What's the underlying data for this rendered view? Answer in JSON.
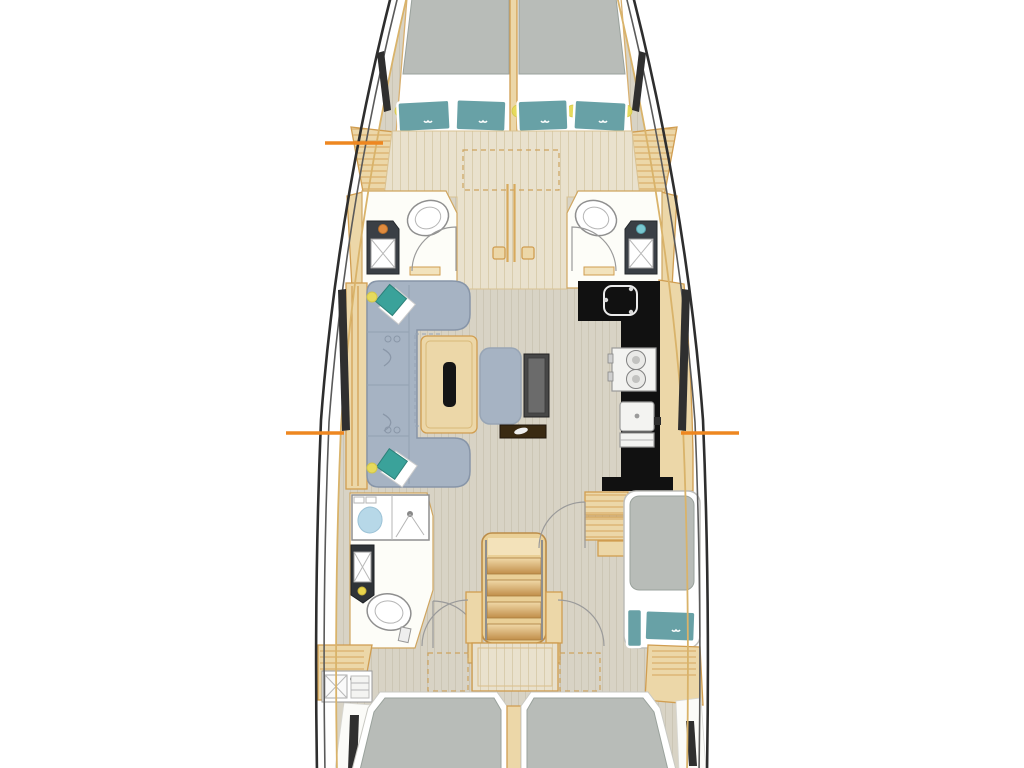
{
  "title": "Sailing yacht interior layout plan (top view)",
  "colors": {
    "page_bg": "#ffffff",
    "hull_outline": "#2e2e2e",
    "deck_trim": "#d9b36a",
    "floor_forward": "#e9e1cd",
    "floor_salon": "#d8d3c5",
    "wood": "#ecd7a8",
    "wood_border": "#d09d50",
    "mattress_gray": "#b8bcb8",
    "pillow_teal": "#68a1a6",
    "sofa_blue": "#a6b3c3",
    "cushion_teal": "#3aa29a",
    "counter_black": "#111111",
    "chart_table_dark": "#474747",
    "shelf_brown": "#3a2a12",
    "vanity_dark": "#3a3f45",
    "shower_blue": "#b7d8e8",
    "accent_orange": "#ee8720",
    "reading_light_yellow": "#e6da5c",
    "faucet_orange": "#e08b3e",
    "faucet_teal": "#79c7d0",
    "window_dark": "#2f2f2f"
  },
  "plan": {
    "bow_cabin": {
      "berth": "V-berth double",
      "mattresses": 2,
      "pillows": 4,
      "reading_lights": 5
    },
    "forward_heads": {
      "count": 2,
      "fixtures_each": [
        "toilet",
        "vanity-sink"
      ]
    },
    "salon": {
      "sofa": "U-shaped",
      "accent_cushions": 2,
      "table_with_slot": 1,
      "nav_seat": 1,
      "chart_table": 1,
      "shelf": 1
    },
    "galley": {
      "shape": "L",
      "sink": 1,
      "stove_burners": 2,
      "appliance_boxes": 2
    },
    "aft_bathroom": {
      "shower": 1,
      "vanity_sink": 1,
      "toilet": 1
    },
    "companionway": {
      "stair_treads": 4,
      "door_arcs": 2
    },
    "aft_single_berth": {
      "mattresses": 1,
      "pillows": 2,
      "step_lockers": 2
    },
    "aft_double_berths": {
      "count": 2
    },
    "utility_sink_aft": 1,
    "hull_windows": 6,
    "section_markers": {
      "count": 3,
      "positions": [
        "port fore",
        "port mid",
        "starboard mid"
      ]
    }
  }
}
